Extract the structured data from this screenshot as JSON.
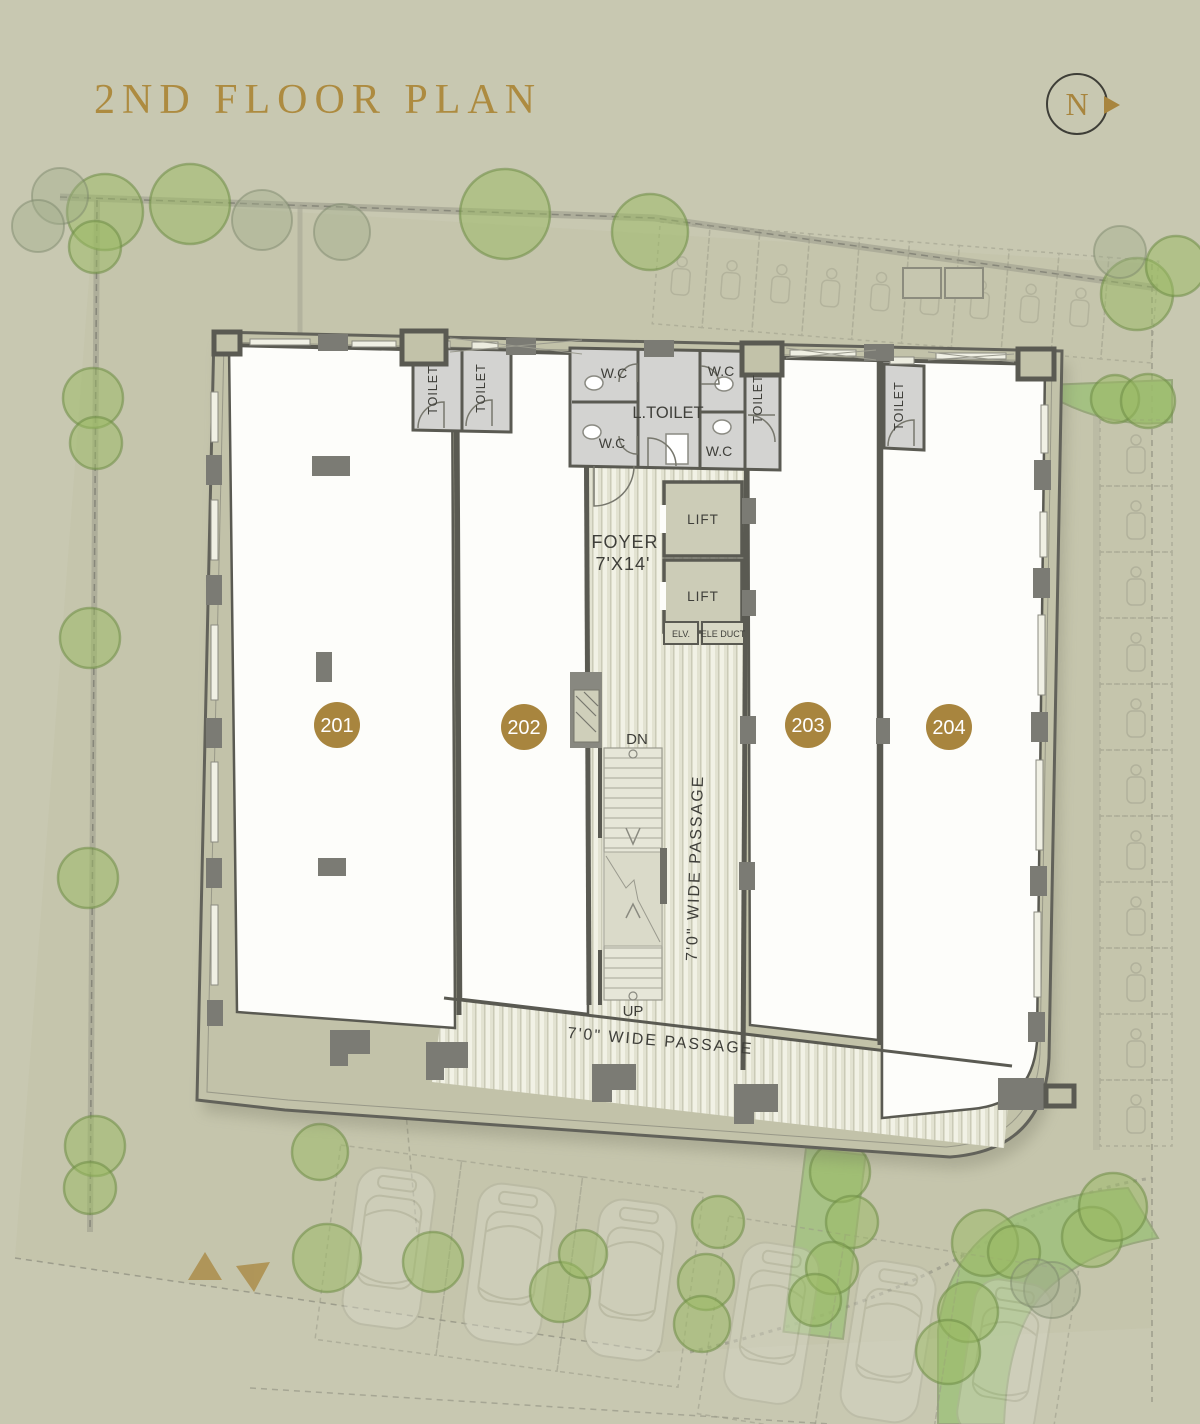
{
  "header": {
    "title": "2ND FLOOR PLAN",
    "north_label": "N"
  },
  "units": [
    {
      "number": "201"
    },
    {
      "number": "202"
    },
    {
      "number": "203"
    },
    {
      "number": "204"
    }
  ],
  "rooms": {
    "toilet": "TOILET",
    "wc": "W.C",
    "l_toilet": "L.TOILET",
    "lift": "LIFT",
    "elv": "ELV.",
    "ele_duct": "ELE DUCT",
    "foyer_line1": "FOYER",
    "foyer_line2": "7'X14'"
  },
  "circulation": {
    "down": "DN",
    "up": "UP",
    "passage": "7'0\" WIDE PASSAGE"
  },
  "colors": {
    "gold": "#a8853e",
    "title_gold": "#ad8b40",
    "paper": "#c8c8b1",
    "band": "#c2c2a9",
    "wall": "#55554d",
    "room_gray": "#d3d3d1",
    "white": "#fdfdfa",
    "stripe": "#e2e2d1",
    "tree_green": "#9aba62",
    "lawn_green": "#9cc178",
    "text_dark": "#3f3f3a"
  }
}
